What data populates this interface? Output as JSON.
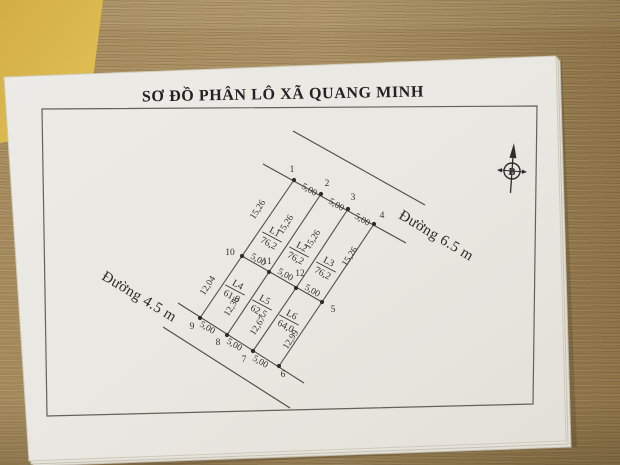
{
  "photo": {
    "desk_color": "#a78d5f",
    "sticky_note_color": "#d9b84f",
    "paper_color": "#eae8e2"
  },
  "document": {
    "title": "SƠ ĐỒ PHÂN LÔ XÃ QUANG MINH",
    "north_label": "B",
    "roads": [
      {
        "label": "Đường 6.5 m"
      },
      {
        "label": "Đường 4.5 m"
      }
    ]
  },
  "diagram": {
    "line_color": "#4e4b46",
    "text_color": "#33302c",
    "boundary_lines": [
      {
        "name": "road-65-outer-edge",
        "x1": 293,
        "y1": 131,
        "x2": 425,
        "y2": 205
      },
      {
        "name": "road-65-frontage-line",
        "x1": 263,
        "y1": 164,
        "x2": 406,
        "y2": 243
      },
      {
        "name": "middle-boundary-line",
        "x1": 242,
        "y1": 256,
        "x2": 322,
        "y2": 302
      },
      {
        "name": "road-45-frontage-line",
        "x1": 178,
        "y1": 303,
        "x2": 304,
        "y2": 383
      },
      {
        "name": "road-45-outer-edge",
        "x1": 163,
        "y1": 327,
        "x2": 290,
        "y2": 408
      },
      {
        "name": "edge-1-10",
        "x1": 294,
        "y1": 180,
        "x2": 242,
        "y2": 256
      },
      {
        "name": "edge-2-11",
        "x1": 321,
        "y1": 194,
        "x2": 269,
        "y2": 272
      },
      {
        "name": "edge-3-12",
        "x1": 348,
        "y1": 209,
        "x2": 296,
        "y2": 288
      },
      {
        "name": "edge-4-5",
        "x1": 374,
        "y1": 224,
        "x2": 322,
        "y2": 302
      },
      {
        "name": "edge-10-9",
        "x1": 242,
        "y1": 256,
        "x2": 200,
        "y2": 318
      },
      {
        "name": "edge-11-8",
        "x1": 269,
        "y1": 272,
        "x2": 227,
        "y2": 335
      },
      {
        "name": "edge-12-7",
        "x1": 296,
        "y1": 288,
        "x2": 253,
        "y2": 351
      },
      {
        "name": "edge-5-6",
        "x1": 322,
        "y1": 302,
        "x2": 279,
        "y2": 366
      }
    ],
    "survey_points": [
      {
        "id": "1",
        "x": 294,
        "y": 180,
        "lx": 292,
        "ly": 172
      },
      {
        "id": "2",
        "x": 321,
        "y": 194,
        "lx": 327,
        "ly": 186
      },
      {
        "id": "3",
        "x": 348,
        "y": 209,
        "lx": 353,
        "ly": 200
      },
      {
        "id": "4",
        "x": 374,
        "y": 224,
        "lx": 382,
        "ly": 218
      },
      {
        "id": "5",
        "x": 322,
        "y": 302,
        "lx": 333,
        "ly": 312
      },
      {
        "id": "6",
        "x": 279,
        "y": 366,
        "lx": 283,
        "ly": 377
      },
      {
        "id": "7",
        "x": 253,
        "y": 351,
        "lx": 244,
        "ly": 362
      },
      {
        "id": "8",
        "x": 227,
        "y": 335,
        "lx": 218,
        "ly": 345
      },
      {
        "id": "9",
        "x": 200,
        "y": 318,
        "lx": 192,
        "ly": 329
      },
      {
        "id": "10",
        "x": 242,
        "y": 256,
        "lx": 230,
        "ly": 255
      },
      {
        "id": "11",
        "x": 269,
        "y": 272,
        "lx": 267,
        "ly": 264
      },
      {
        "id": "12",
        "x": 296,
        "y": 288,
        "lx": 300,
        "ly": 276
      }
    ],
    "dimensions": [
      {
        "text": "5,00",
        "x": 308,
        "y": 192,
        "rot": 30
      },
      {
        "text": "5,00",
        "x": 335,
        "y": 207,
        "rot": 30
      },
      {
        "text": "5,00",
        "x": 361,
        "y": 222,
        "rot": 30
      },
      {
        "text": "5,00",
        "x": 257,
        "y": 262,
        "rot": 30
      },
      {
        "text": "5,00",
        "x": 284,
        "y": 277,
        "rot": 30
      },
      {
        "text": "5,00",
        "x": 311,
        "y": 293,
        "rot": 30
      },
      {
        "text": "5,00",
        "x": 206,
        "y": 330,
        "rot": 30
      },
      {
        "text": "5,00",
        "x": 233,
        "y": 347,
        "rot": 30
      },
      {
        "text": "5,00",
        "x": 259,
        "y": 364,
        "rot": 30
      },
      {
        "text": "15,26",
        "x": 260,
        "y": 211,
        "rot": -57
      },
      {
        "text": "15,26",
        "x": 288,
        "y": 226,
        "rot": -57
      },
      {
        "text": "15,26",
        "x": 315,
        "y": 241,
        "rot": -57
      },
      {
        "text": "15,26",
        "x": 352,
        "y": 258,
        "rot": -57
      },
      {
        "text": "12,04",
        "x": 210,
        "y": 287,
        "rot": -57
      },
      {
        "text": "12,36",
        "x": 234,
        "y": 308,
        "rot": -57
      },
      {
        "text": "12,67",
        "x": 260,
        "y": 327,
        "rot": -57
      },
      {
        "text": "12,99",
        "x": 293,
        "y": 341,
        "rot": -57
      }
    ],
    "plots": [
      {
        "id": "L1",
        "area": "76,2",
        "x": 272,
        "y": 237,
        "rot": 28
      },
      {
        "id": "L2",
        "area": "76,2",
        "x": 299,
        "y": 252,
        "rot": 28
      },
      {
        "id": "L3",
        "area": "76,2",
        "x": 326,
        "y": 267,
        "rot": 28
      },
      {
        "id": "L4",
        "area": "61,0",
        "x": 235,
        "y": 290,
        "rot": 28
      },
      {
        "id": "L5",
        "area": "62,5",
        "x": 262,
        "y": 305,
        "rot": 28
      },
      {
        "id": "L6",
        "area": "64,0",
        "x": 289,
        "y": 320,
        "rot": 28
      }
    ]
  }
}
